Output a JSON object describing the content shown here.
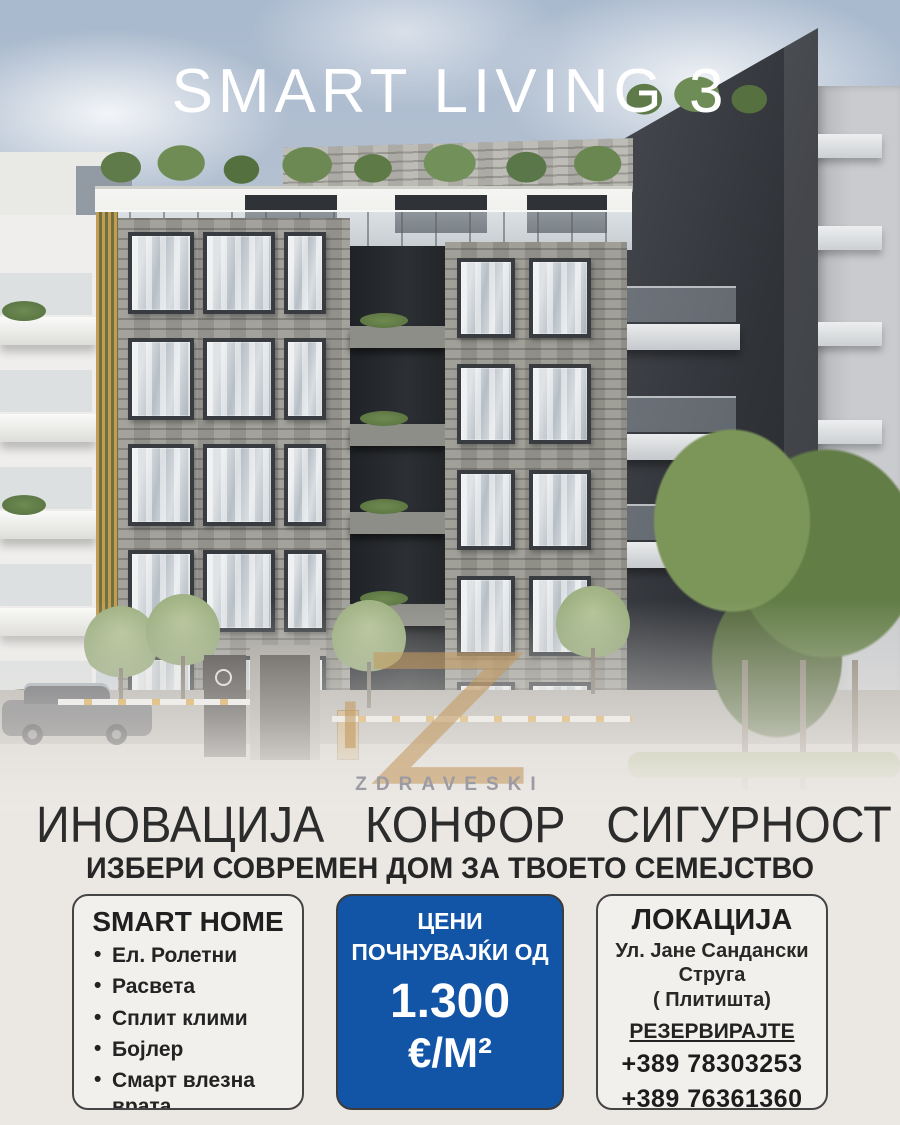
{
  "poster": {
    "title": "SMART LIVING 3",
    "brand": "ZDRAVESKI",
    "headline": "ИНОВАЦИЈА КОНФОР СИГУРНОСТ",
    "subheadline": "ИЗБЕРИ СОВРЕМЕН ДОМ ЗА ТВОЕТО СЕМЕЈСТВО"
  },
  "smart_home": {
    "title": "SMART HOME",
    "items": [
      "Ел. Ролетни",
      "Расвета",
      "Сплит клими",
      "Бојлер",
      "Смарт влезна врата"
    ]
  },
  "price": {
    "line1": "ЦЕНИ",
    "line2": "ПОЧНУВАЈЌИ ОД",
    "amount": "1.300",
    "unit": "€/М²",
    "bg_color": "#1254a6"
  },
  "location": {
    "title": "ЛОКАЦИЈА",
    "address1": "Ул. Јане Сандански",
    "address2": "Струга",
    "address3": "( Плитишта)",
    "reserve": "РЕЗЕРВИРАЈТЕ",
    "phone1": "+389 78303253",
    "phone2": "+389 76361360"
  }
}
